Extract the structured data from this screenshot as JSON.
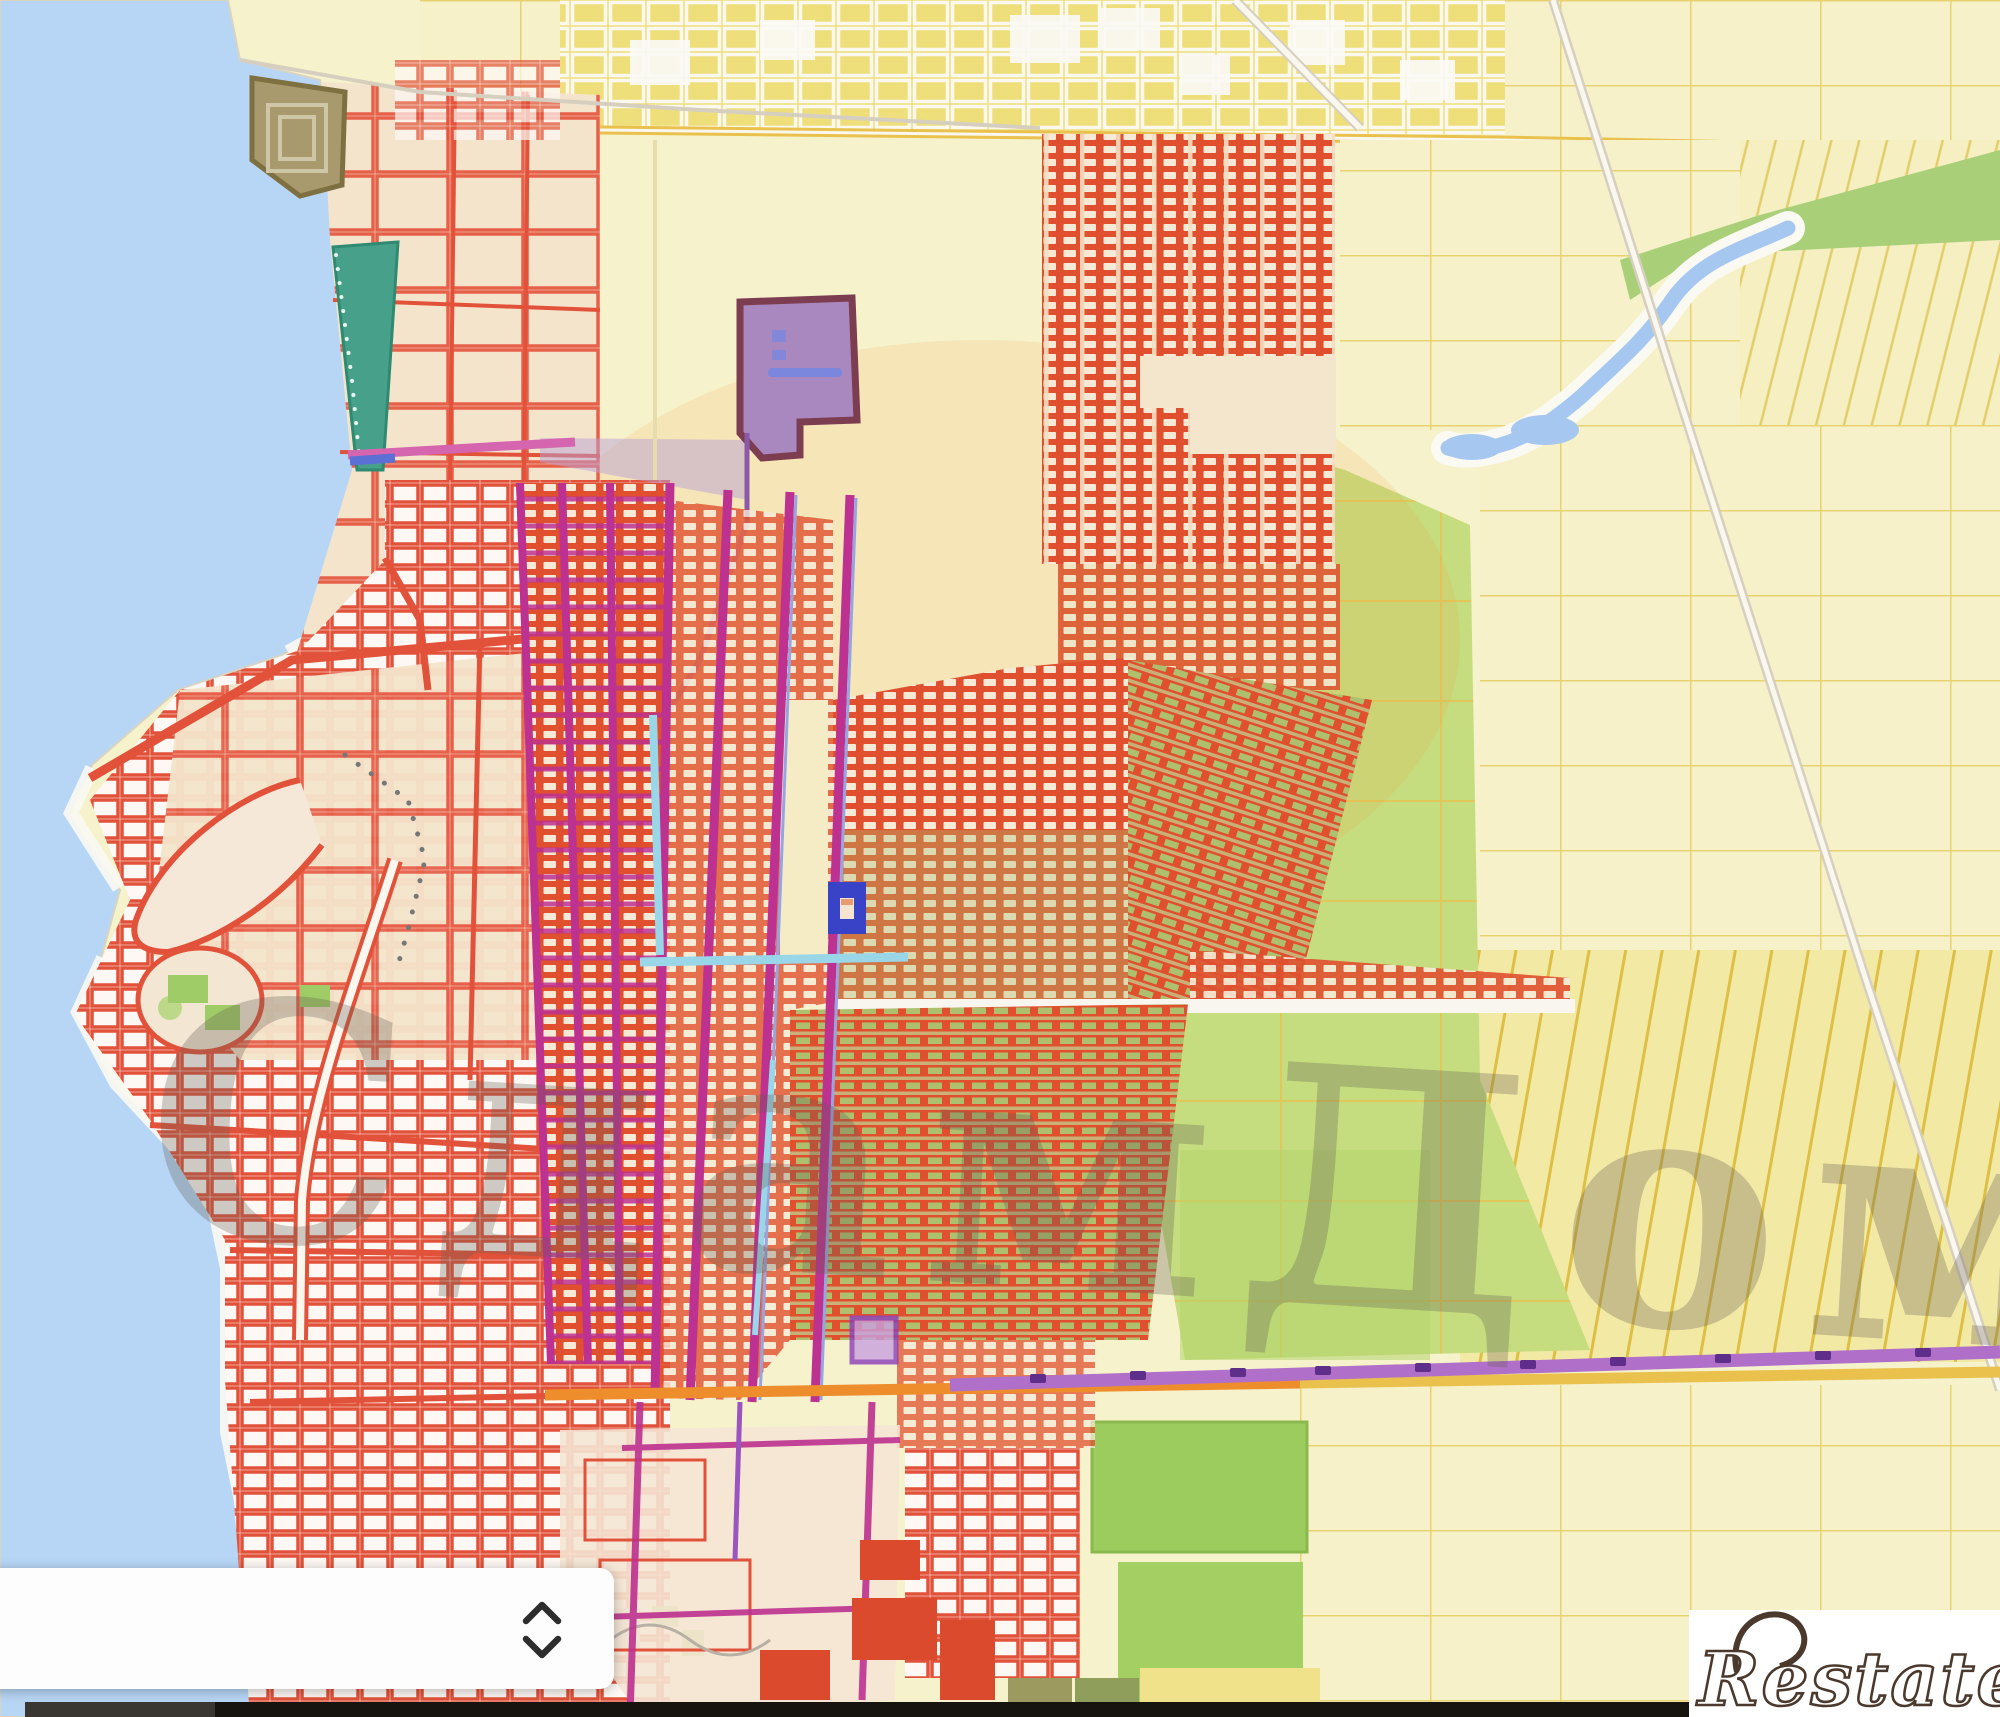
{
  "watermark": {
    "text": "СдамДом"
  },
  "logo": {
    "text": "Restate"
  },
  "panel": {
    "chevron_up": "chevron-up",
    "chevron_down": "chevron-down"
  },
  "marker": {
    "label": "selected-parcel",
    "color": "#3843c8"
  },
  "colors": {
    "c-water": "#b7d6f5",
    "c-base": "#f6f2cc",
    "c-beige": "#f4e4cb",
    "c-red-line": "#e2523a",
    "c-red-fill": "#e0502f",
    "c-cell": "#f6e9d6",
    "c-olive": "#aebf6e",
    "c-tan": "#c8b077",
    "c-ydense": "#eedf7b",
    "c-yline": "#e7d26f",
    "c-green": "#c5dd7e",
    "c-green-dark": "#a9d079",
    "c-teal": "#47a18a",
    "c-brown": "#a89a6c",
    "c-magenta": "#bd3190",
    "c-purple-road": "#b06fc8",
    "c-orange-road": "#ee8d2c",
    "c-yellow-road": "#e9c14c",
    "c-purple-poly": "#a988c0",
    "c-lavender": "#b9a0d6",
    "c-cyan": "#99d6e8",
    "c-marker": "#3843c8",
    "c-blue-road": "#5b6fd4",
    "c-pink": "#d565ae",
    "c-bar-dark": "#17130e",
    "c-bar-gray": "#3a3632",
    "c-logo": "#4a392c"
  }
}
